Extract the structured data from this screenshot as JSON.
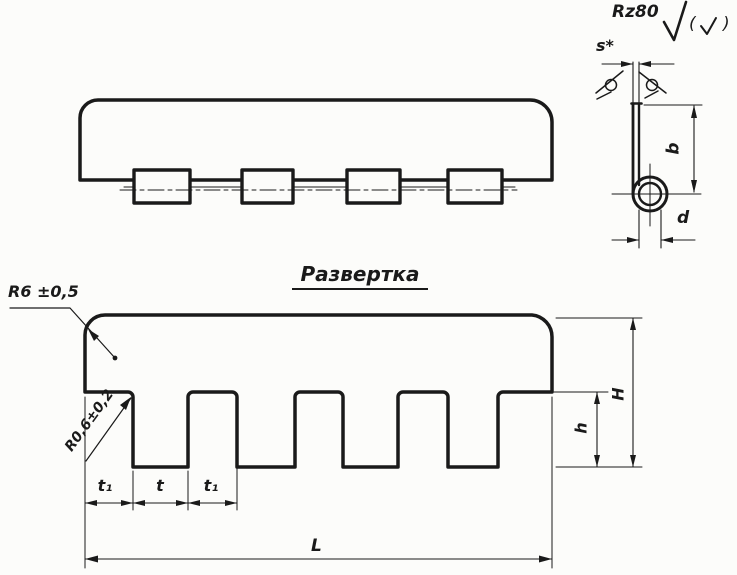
{
  "colors": {
    "ink": "#1a1a1a",
    "paper": "#fcfcfa"
  },
  "surface_note": {
    "roughness": "Rz80",
    "paren_open": "(",
    "paren_close": ")"
  },
  "section_view": {
    "thickness_label": "s*",
    "height_label": "b",
    "diameter_label": "d"
  },
  "flat_pattern": {
    "title": "Развертка",
    "corner_radius_label": "R6 ±0,5",
    "notch_radius_label": "R0,6±0,2",
    "edge_offset_label": "t₁",
    "tab_pitch_label": "t",
    "gap_label": "t₁",
    "length_label": "L",
    "tab_height_label": "h",
    "height_label": "H"
  }
}
